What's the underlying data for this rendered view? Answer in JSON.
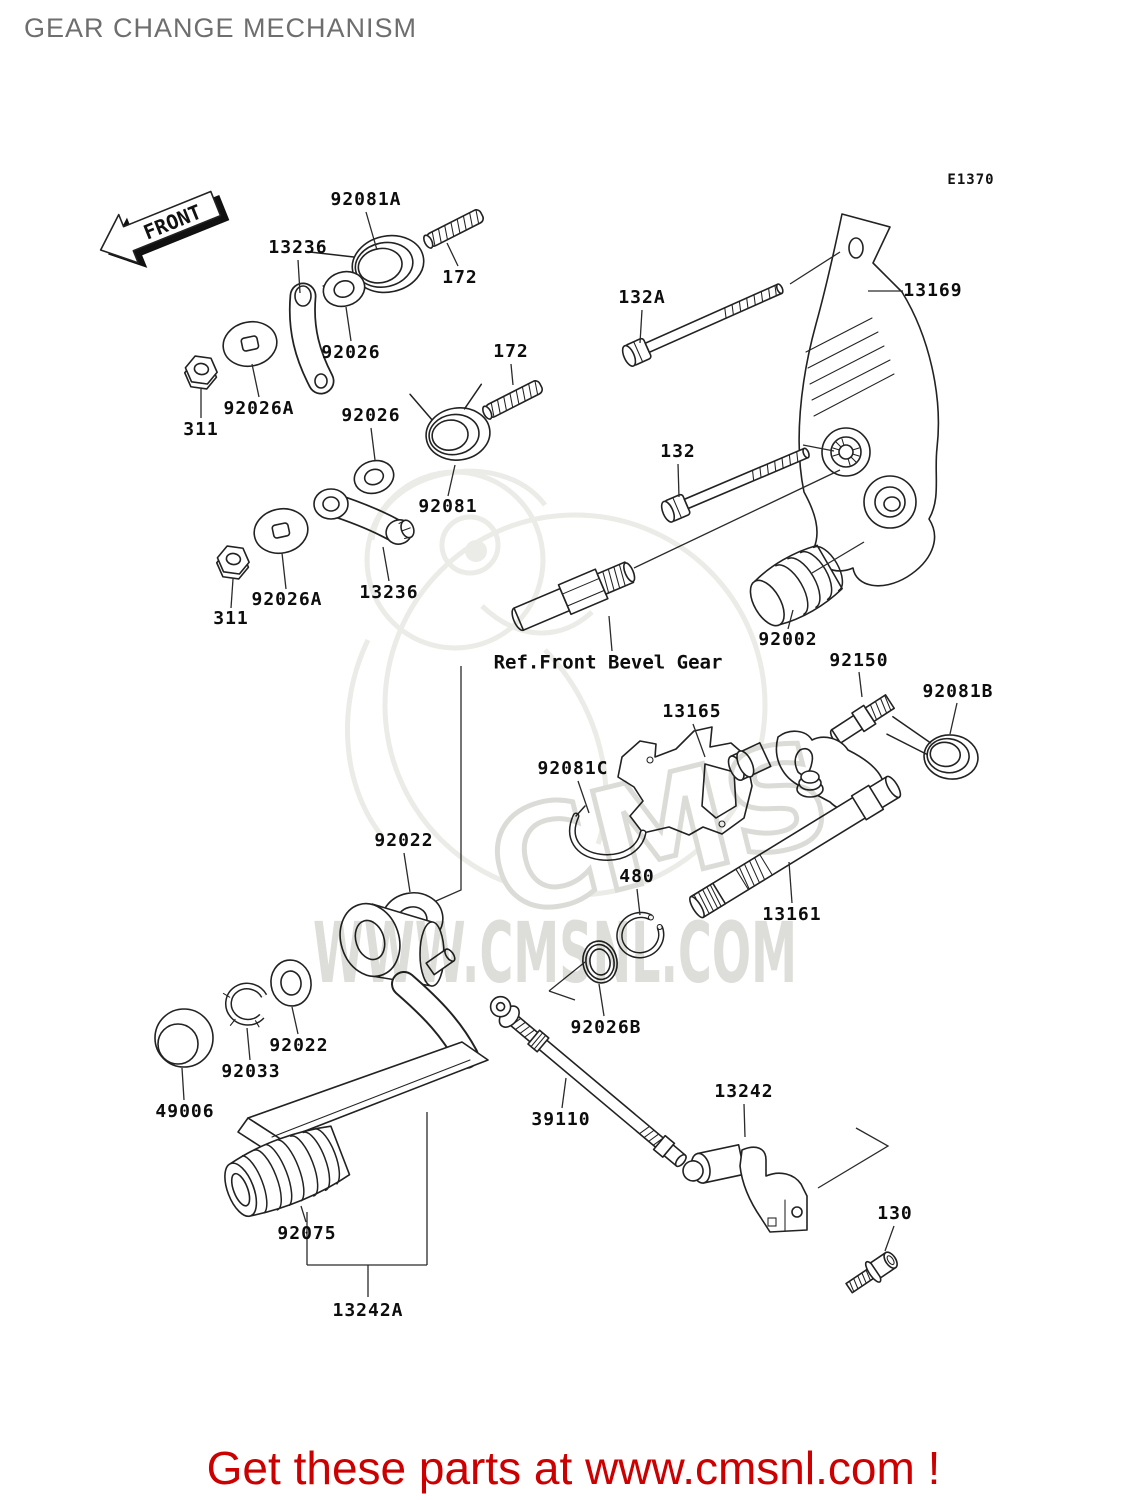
{
  "header": {
    "title": "GEAR CHANGE MECHANISM",
    "diagram_code": "E1370"
  },
  "front": {
    "label": "FRONT"
  },
  "watermark": {
    "brand": "CMS",
    "url_text": "WWW.CMSNL.COM",
    "color": "#d9d9d5"
  },
  "footer": {
    "text": "Get these parts at www.cmsnl.com !",
    "color": "#cc0000"
  },
  "ref_note": {
    "text": "Ref.Front Bevel Gear",
    "x": 608,
    "y": 663
  },
  "parts": [
    {
      "label": "92081A",
      "x": 366,
      "y": 200
    },
    {
      "label": "13236",
      "x": 298,
      "y": 248
    },
    {
      "label": "172",
      "x": 460,
      "y": 278
    },
    {
      "label": "132A",
      "x": 642,
      "y": 298
    },
    {
      "label": "13169",
      "x": 933,
      "y": 291
    },
    {
      "label": "92026",
      "x": 351,
      "y": 353
    },
    {
      "label": "172",
      "x": 511,
      "y": 352
    },
    {
      "label": "92026A",
      "x": 259,
      "y": 409
    },
    {
      "label": "311",
      "x": 201,
      "y": 430
    },
    {
      "label": "92026",
      "x": 371,
      "y": 416
    },
    {
      "label": "132",
      "x": 678,
      "y": 452
    },
    {
      "label": "92081",
      "x": 448,
      "y": 507
    },
    {
      "label": "13236",
      "x": 389,
      "y": 593
    },
    {
      "label": "92026A",
      "x": 287,
      "y": 600
    },
    {
      "label": "311",
      "x": 231,
      "y": 619
    },
    {
      "label": "92002",
      "x": 788,
      "y": 640
    },
    {
      "label": "92150",
      "x": 859,
      "y": 661
    },
    {
      "label": "92081B",
      "x": 958,
      "y": 692
    },
    {
      "label": "13165",
      "x": 692,
      "y": 712
    },
    {
      "label": "92081C",
      "x": 573,
      "y": 769
    },
    {
      "label": "92022",
      "x": 404,
      "y": 841
    },
    {
      "label": "480",
      "x": 637,
      "y": 877
    },
    {
      "label": "13161",
      "x": 792,
      "y": 915
    },
    {
      "label": "92026B",
      "x": 606,
      "y": 1028
    },
    {
      "label": "92022",
      "x": 299,
      "y": 1046
    },
    {
      "label": "92033",
      "x": 251,
      "y": 1072
    },
    {
      "label": "49006",
      "x": 185,
      "y": 1112
    },
    {
      "label": "39110",
      "x": 561,
      "y": 1120
    },
    {
      "label": "13242",
      "x": 744,
      "y": 1092
    },
    {
      "label": "92075",
      "x": 307,
      "y": 1234
    },
    {
      "label": "130",
      "x": 895,
      "y": 1214
    },
    {
      "label": "13242A",
      "x": 368,
      "y": 1311
    }
  ]
}
